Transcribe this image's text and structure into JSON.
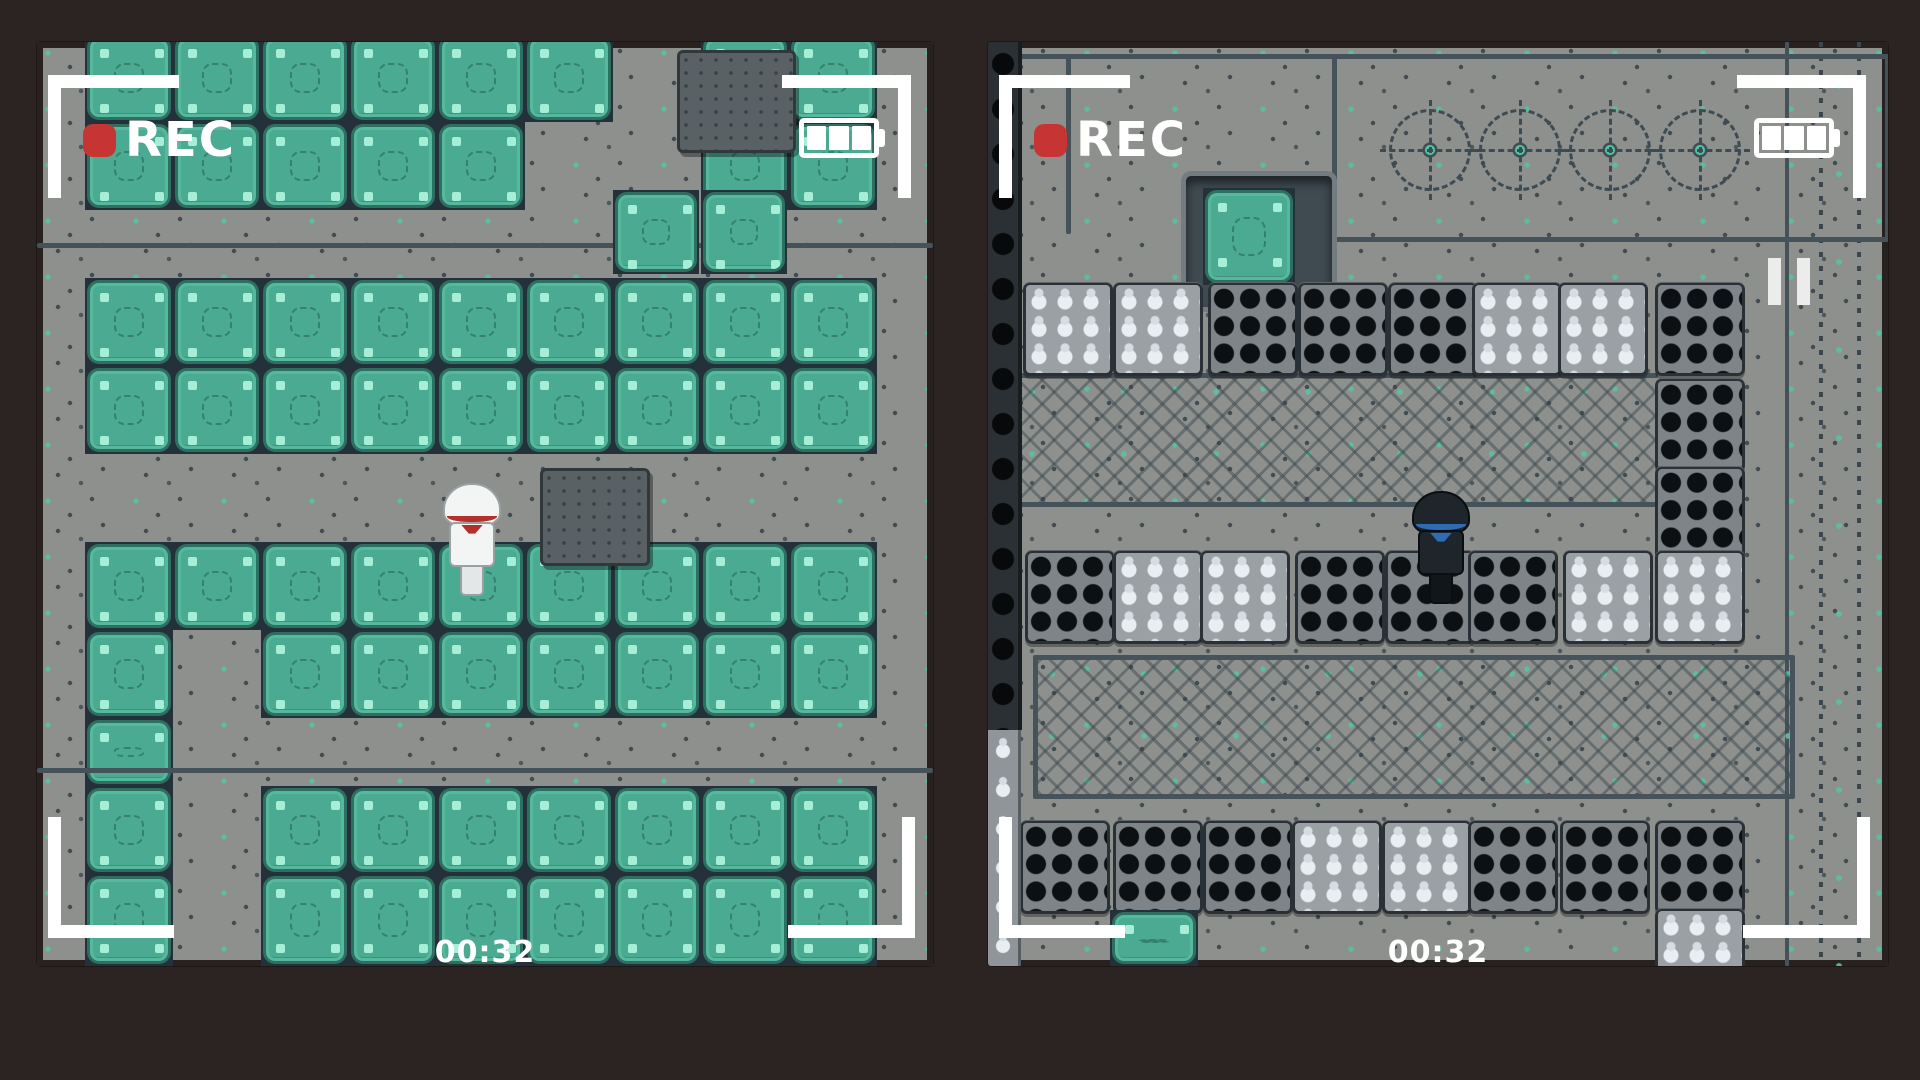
{
  "app": "game-camera-recording-view",
  "colors": {
    "background": "#2b2422",
    "tile_green": "#4bab92",
    "tile_green_border": "#2d6f60",
    "tile_mint_accent": "#a7eed7",
    "floor_gray": "#8e908d",
    "floor_mint_dot": "#57c2a2",
    "seam_slate": "#45525a",
    "tile_gap_dark": "#25313a",
    "crate_hole_black": "#0c1013",
    "sack_white": "#e8eef1",
    "rec_red": "#c63434",
    "overlay_white": "#ffffff",
    "character_light_band_red": "#b5302b",
    "character_dark_band_blue": "#2d6db3"
  },
  "legend": {
    "G": "green-panel-tile",
    "P": "metal-walkway"
  },
  "panels": [
    {
      "name": "camera-view-green-room",
      "x": 37,
      "y": 42,
      "w": 896,
      "h": 924,
      "overlay": {
        "rec_label": "REC",
        "timer": "00:32",
        "battery_bars": 3,
        "paused": false
      },
      "grid": {
        "origin_x": 48,
        "tile": 88,
        "rows": [
          {
            "y": -8,
            "h": 88,
            "cells": "GGGGGGPGG"
          },
          {
            "y": 80,
            "h": 88,
            "cells": "GGGGGPPGG"
          },
          {
            "y": 168,
            "h": 68,
            "cells": "PPPPPPPPP"
          },
          {
            "y": 236,
            "h": 88,
            "cells": "GGGGGGGGG"
          },
          {
            "y": 324,
            "h": 88,
            "cells": "GGGGGGGGG"
          },
          {
            "y": 412,
            "h": 88,
            "cells": "PPPPPPPPP"
          },
          {
            "y": 500,
            "h": 88,
            "cells": "GGGGGGGGG"
          },
          {
            "y": 588,
            "h": 88,
            "cells": "GPGGGGGGG"
          },
          {
            "y": 676,
            "h": 68,
            "cells": "GPPPPPPPP"
          },
          {
            "y": 744,
            "h": 88,
            "cells": "GPGGGGGGG"
          },
          {
            "y": 832,
            "h": 92,
            "cells": "GPGGGGGGG"
          }
        ]
      },
      "props": [
        {
          "type": "hline",
          "x": 0,
          "y": 201,
          "w": 896
        },
        {
          "type": "hline",
          "x": 0,
          "y": 726,
          "w": 896
        },
        {
          "type": "monitor",
          "x": 640,
          "y": 8,
          "w": 113,
          "h": 97
        },
        {
          "type": "green-tile",
          "x": 576,
          "y": 148,
          "w": 86,
          "h": 84
        },
        {
          "type": "green-tile",
          "x": 664,
          "y": 148,
          "w": 86,
          "h": 84
        },
        {
          "type": "monitor",
          "x": 503,
          "y": 426,
          "w": 104,
          "h": 92
        }
      ],
      "character": {
        "variant": "light",
        "x": 408,
        "y": 443,
        "w": 54,
        "h": 110
      }
    },
    {
      "name": "camera-view-crate-warehouse",
      "x": 988,
      "y": 42,
      "w": 900,
      "h": 924,
      "overlay": {
        "rec_label": "REC",
        "timer": "00:32",
        "battery_bars": 3,
        "paused": true
      },
      "props": [
        {
          "type": "vstrip",
          "x": 797,
          "y": 0,
          "w": 103,
          "h": 924
        },
        {
          "type": "hline",
          "x": 0,
          "y": 12,
          "w": 900
        },
        {
          "type": "vline",
          "x": 78,
          "y": 16,
          "h": 176
        },
        {
          "type": "frame",
          "x": 344,
          "y": 12,
          "w": 548,
          "h": 178
        },
        {
          "type": "dial",
          "x": 401,
          "y": 67,
          "w": 76,
          "h": 76
        },
        {
          "type": "dial",
          "x": 491,
          "y": 67,
          "w": 76,
          "h": 76
        },
        {
          "type": "dial",
          "x": 581,
          "y": 67,
          "w": 76,
          "h": 76
        },
        {
          "type": "dial",
          "x": 671,
          "y": 67,
          "w": 76,
          "h": 76
        },
        {
          "type": "pit",
          "x": 193,
          "y": 129,
          "w": 146,
          "h": 131
        },
        {
          "type": "green-tile",
          "x": 215,
          "y": 146,
          "w": 92,
          "h": 97
        },
        {
          "type": "hline",
          "x": 30,
          "y": 331,
          "w": 640
        },
        {
          "type": "band",
          "x": 30,
          "y": 336,
          "w": 640,
          "h": 124
        },
        {
          "type": "hline",
          "x": 30,
          "y": 460,
          "w": 640
        },
        {
          "type": "crate-s",
          "x": 35,
          "y": 240
        },
        {
          "type": "crate-s",
          "x": 125,
          "y": 240
        },
        {
          "type": "crate-b",
          "x": 220,
          "y": 240
        },
        {
          "type": "crate-b",
          "x": 310,
          "y": 240
        },
        {
          "type": "crate-b",
          "x": 400,
          "y": 240
        },
        {
          "type": "crate-s",
          "x": 484,
          "y": 240
        },
        {
          "type": "crate-s",
          "x": 570,
          "y": 240
        },
        {
          "type": "crate-b",
          "x": 667,
          "y": 240
        },
        {
          "type": "crate-b",
          "x": 667,
          "y": 336
        },
        {
          "type": "crate-b",
          "x": 667,
          "y": 424
        },
        {
          "type": "crate-b",
          "x": 37,
          "y": 508
        },
        {
          "type": "crate-s",
          "x": 125,
          "y": 508
        },
        {
          "type": "crate-s",
          "x": 212,
          "y": 508
        },
        {
          "type": "crate-b",
          "x": 307,
          "y": 508
        },
        {
          "type": "crate-b",
          "x": 397,
          "y": 508
        },
        {
          "type": "crate-b",
          "x": 480,
          "y": 508
        },
        {
          "type": "crate-s",
          "x": 575,
          "y": 508
        },
        {
          "type": "crate-s",
          "x": 667,
          "y": 508
        },
        {
          "type": "rug",
          "x": 45,
          "y": 613,
          "w": 752,
          "h": 134
        },
        {
          "type": "crate-b",
          "x": 32,
          "y": 778
        },
        {
          "type": "crate-b",
          "x": 125,
          "y": 778
        },
        {
          "type": "crate-b",
          "x": 215,
          "y": 778
        },
        {
          "type": "crate-s",
          "x": 304,
          "y": 778
        },
        {
          "type": "crate-s",
          "x": 394,
          "y": 778
        },
        {
          "type": "crate-b",
          "x": 480,
          "y": 778
        },
        {
          "type": "crate-b",
          "x": 572,
          "y": 778
        },
        {
          "type": "crate-b",
          "x": 667,
          "y": 778
        },
        {
          "type": "crate-s",
          "x": 667,
          "y": 866,
          "w": 84,
          "h": 58
        },
        {
          "type": "green-tile",
          "x": 122,
          "y": 868,
          "w": 88,
          "h": 56
        },
        {
          "type": "black-column",
          "x": 0,
          "y": 0,
          "w": 30,
          "h": 688
        },
        {
          "type": "sack-column",
          "x": 0,
          "y": 688,
          "w": 30,
          "h": 236
        }
      ],
      "character": {
        "variant": "dark",
        "x": 426,
        "y": 451,
        "w": 54,
        "h": 110
      }
    }
  ]
}
